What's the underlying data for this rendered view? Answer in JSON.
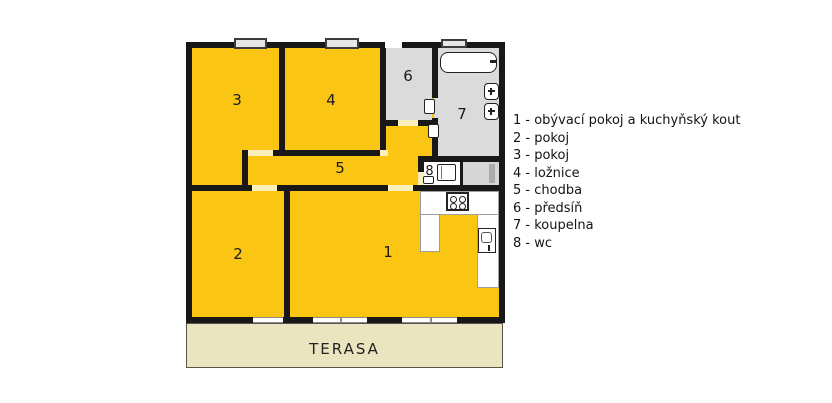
{
  "terrace_label": "TERASA",
  "rooms": {
    "r1": "1",
    "r2": "2",
    "r3": "3",
    "r4": "4",
    "r5": "5",
    "r6": "6",
    "r7": "7",
    "r8": "8"
  },
  "legend": [
    "1 - obývací pokoj a kuchyňský kout",
    "2 - pokoj",
    "3 - pokoj",
    "4 - ložnice",
    "5 - chodba",
    "6 - předsíň",
    "7 - koupelna",
    "8 - wc"
  ],
  "icons": {
    "bathtub": "bathtub-icon",
    "washbasin": "washbasin-icon",
    "toilet": "toilet-icon",
    "hand_sink": "hand-sink-icon",
    "stove": "stove-icon",
    "kitchen_sink": "kitchen-sink-icon",
    "door_leaf": "door-leaf-icon",
    "window": "window-icon"
  },
  "colors": {
    "room_yellow": "#FAC513",
    "service_gray": "#DBDBDB",
    "wall_black": "#181818",
    "door_cream": "#FBF0BC",
    "terrace_beige": "#EBE5BF",
    "counter_white": "#FFFFFF"
  }
}
